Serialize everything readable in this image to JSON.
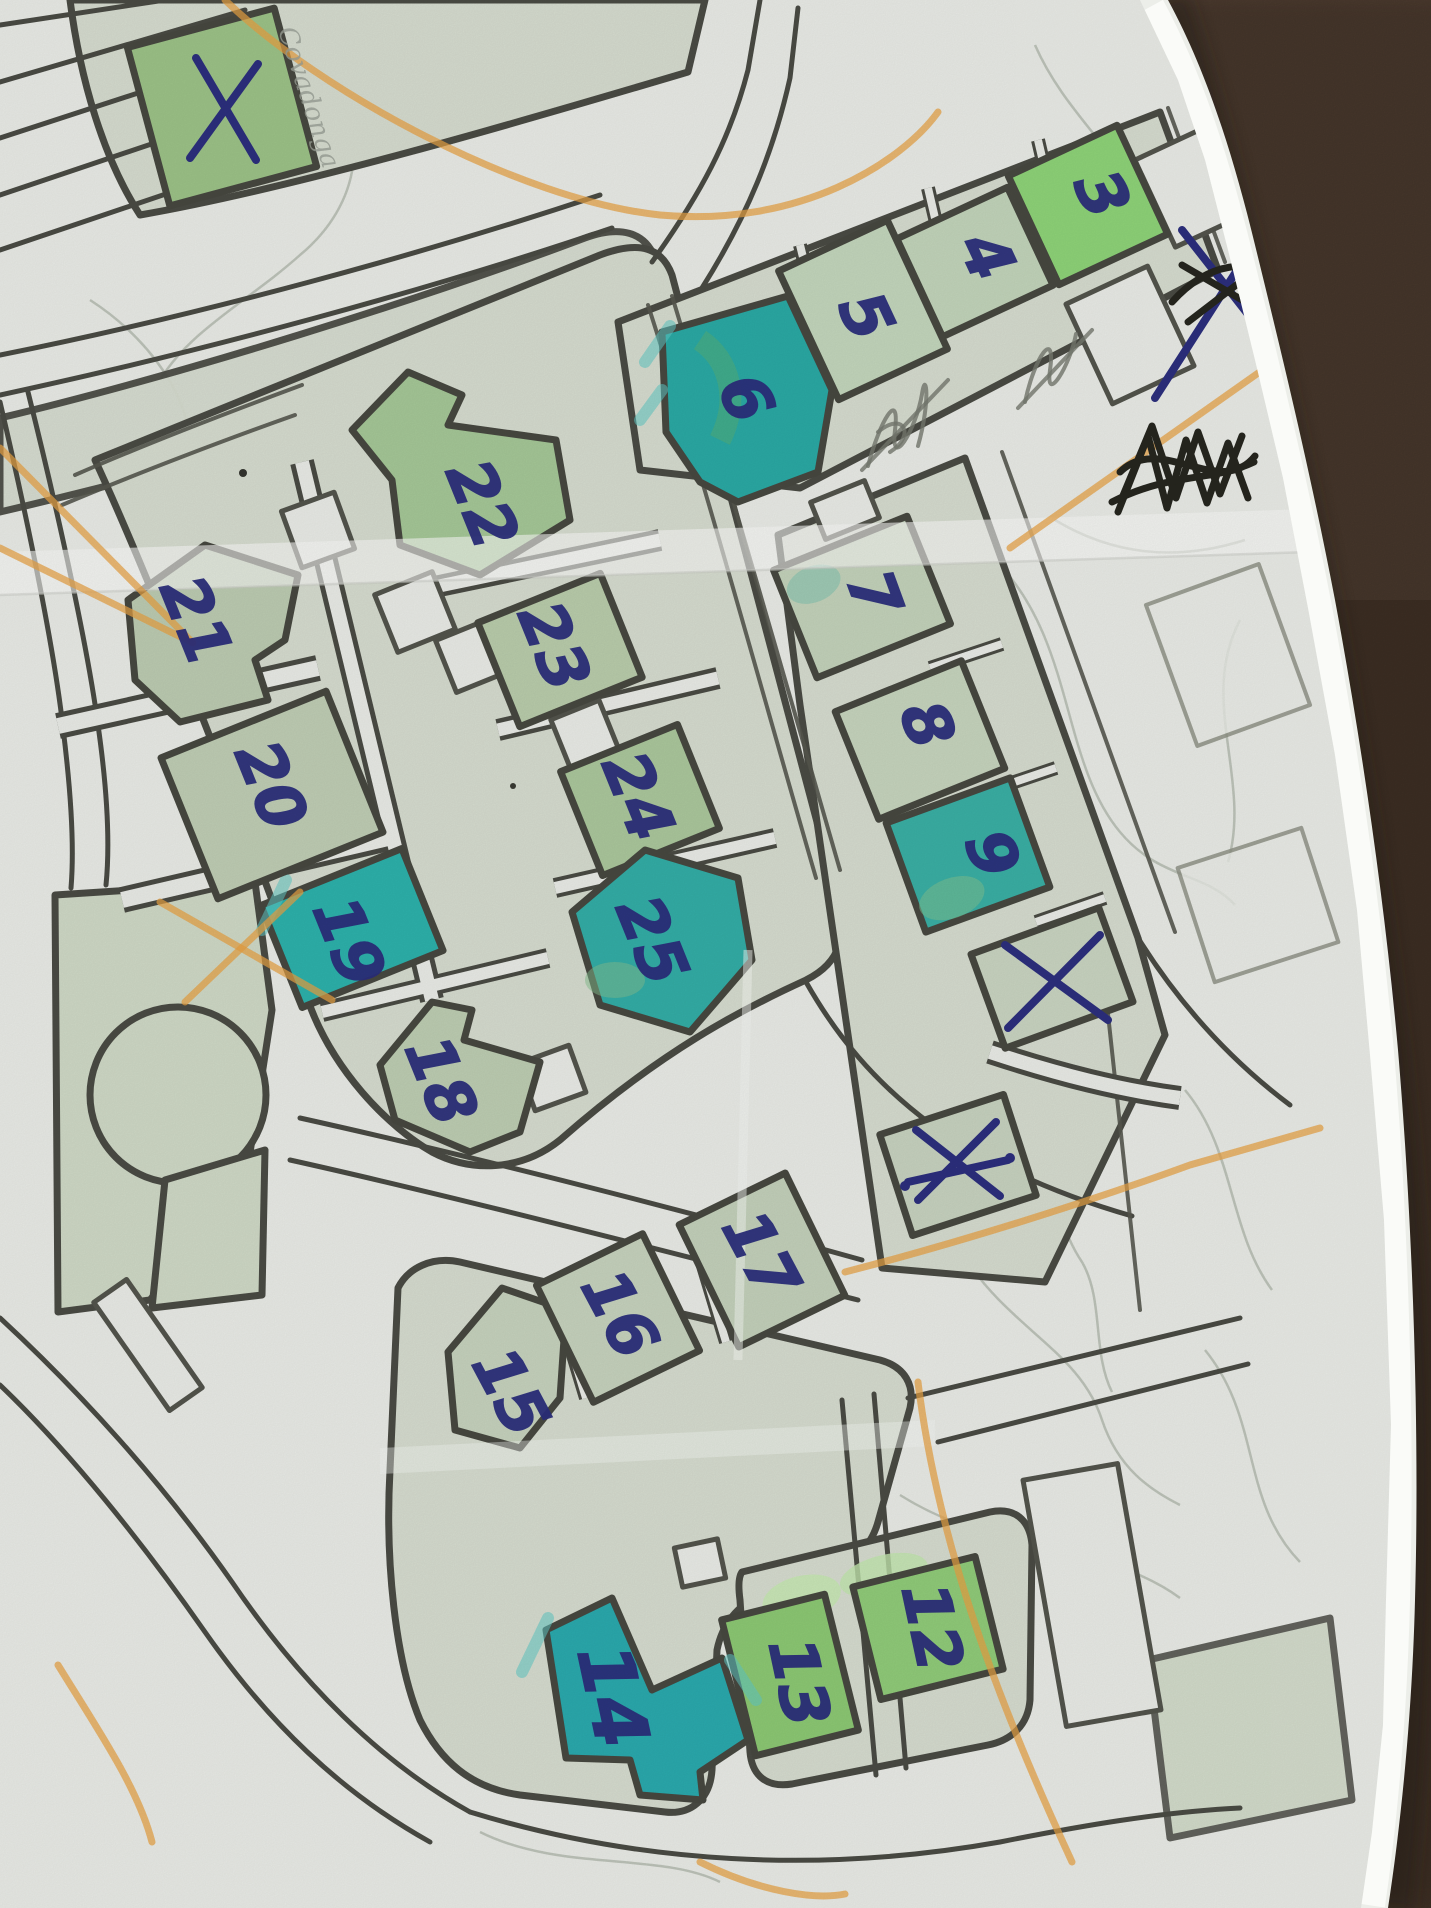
{
  "scene": {
    "kind": "photo of a hand-annotated printed street map lying on a dark brown leather surface",
    "paper_color": "#e9ebe6",
    "leather_color": "#49382d",
    "pen_color": "#2c2f7d",
    "orange_line_color": "#e7a143",
    "teal_highlight_color": "#2baaa6",
    "building_green": "#c4d3ba",
    "bright_green": "#8ed378"
  },
  "map": {
    "street_label": "Covadonga",
    "buildings": [
      {
        "label": "3",
        "highlight": "bright-green"
      },
      {
        "label": "4",
        "highlight": "none"
      },
      {
        "label": "5",
        "highlight": "none"
      },
      {
        "label": "6",
        "highlight": "teal"
      },
      {
        "label": "7",
        "highlight": "none"
      },
      {
        "label": "8",
        "highlight": "none"
      },
      {
        "label": "9",
        "highlight": "teal"
      },
      {
        "label": "12",
        "highlight": "bright-green"
      },
      {
        "label": "13",
        "highlight": "bright-green"
      },
      {
        "label": "14",
        "highlight": "teal"
      },
      {
        "label": "15",
        "highlight": "none"
      },
      {
        "label": "16",
        "highlight": "none"
      },
      {
        "label": "17",
        "highlight": "none"
      },
      {
        "label": "18",
        "highlight": "none"
      },
      {
        "label": "19",
        "highlight": "teal"
      },
      {
        "label": "20",
        "highlight": "none"
      },
      {
        "label": "21",
        "highlight": "none"
      },
      {
        "label": "22",
        "highlight": "none"
      },
      {
        "label": "23",
        "highlight": "none"
      },
      {
        "label": "24",
        "highlight": "none"
      },
      {
        "label": "25",
        "highlight": "teal"
      }
    ],
    "pen_marks": {
      "x_on_top_left_building": "X",
      "x_on_building_right_of_9": "X",
      "x_on_building_below_9": "x",
      "x_in_right_margin": "X (scribbled over in pencil)",
      "blacked_out_word": "heavy black scribble",
      "pencil_scribbles": 2
    }
  }
}
